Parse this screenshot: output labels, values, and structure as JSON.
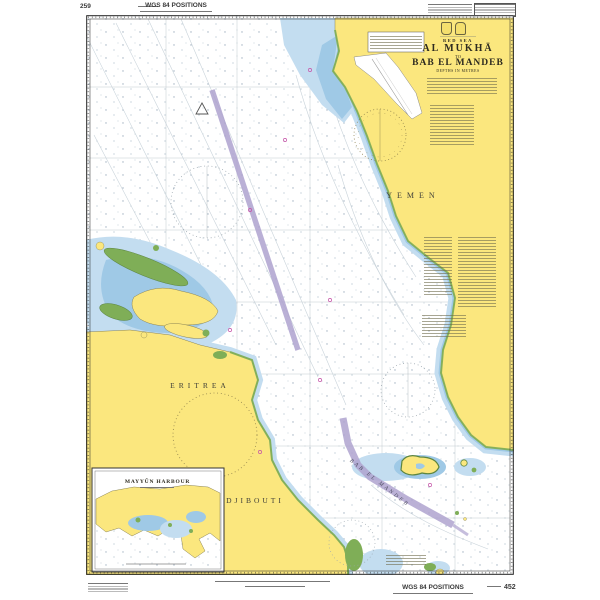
{
  "chart": {
    "margins": {
      "page_number": "259",
      "wgs_top": "WGS 84 POSITIONS",
      "wgs_bottom": "WGS 84 POSITIONS",
      "chart_number": "452"
    },
    "title_block": {
      "sea_area": "RED SEA",
      "title_line_1": "AL MUKHĀ",
      "joiner": "TO",
      "title_line_2": "BAB EL MANDEB",
      "depths_note": "DEPTHS IN METRES"
    },
    "labels": {
      "yemen": "YEMEN",
      "eritrea": "ERITREA",
      "djibouti": "DJIBOUTI",
      "mayyun_inset_title": "MAYYŪN HARBOUR",
      "strait": "BAB EL MANDEB"
    },
    "colors": {
      "land_yellow": "#FBE77E",
      "shallow_blue": "#C3DDF0",
      "shoal_blue": "#9FC9E6",
      "drying_green": "#7FAE57",
      "tss_purple": "#AFA3CF",
      "magenta": "#C653A8",
      "contour_gray": "#C9D3DA",
      "sea_white": "#FFFFFF"
    }
  }
}
